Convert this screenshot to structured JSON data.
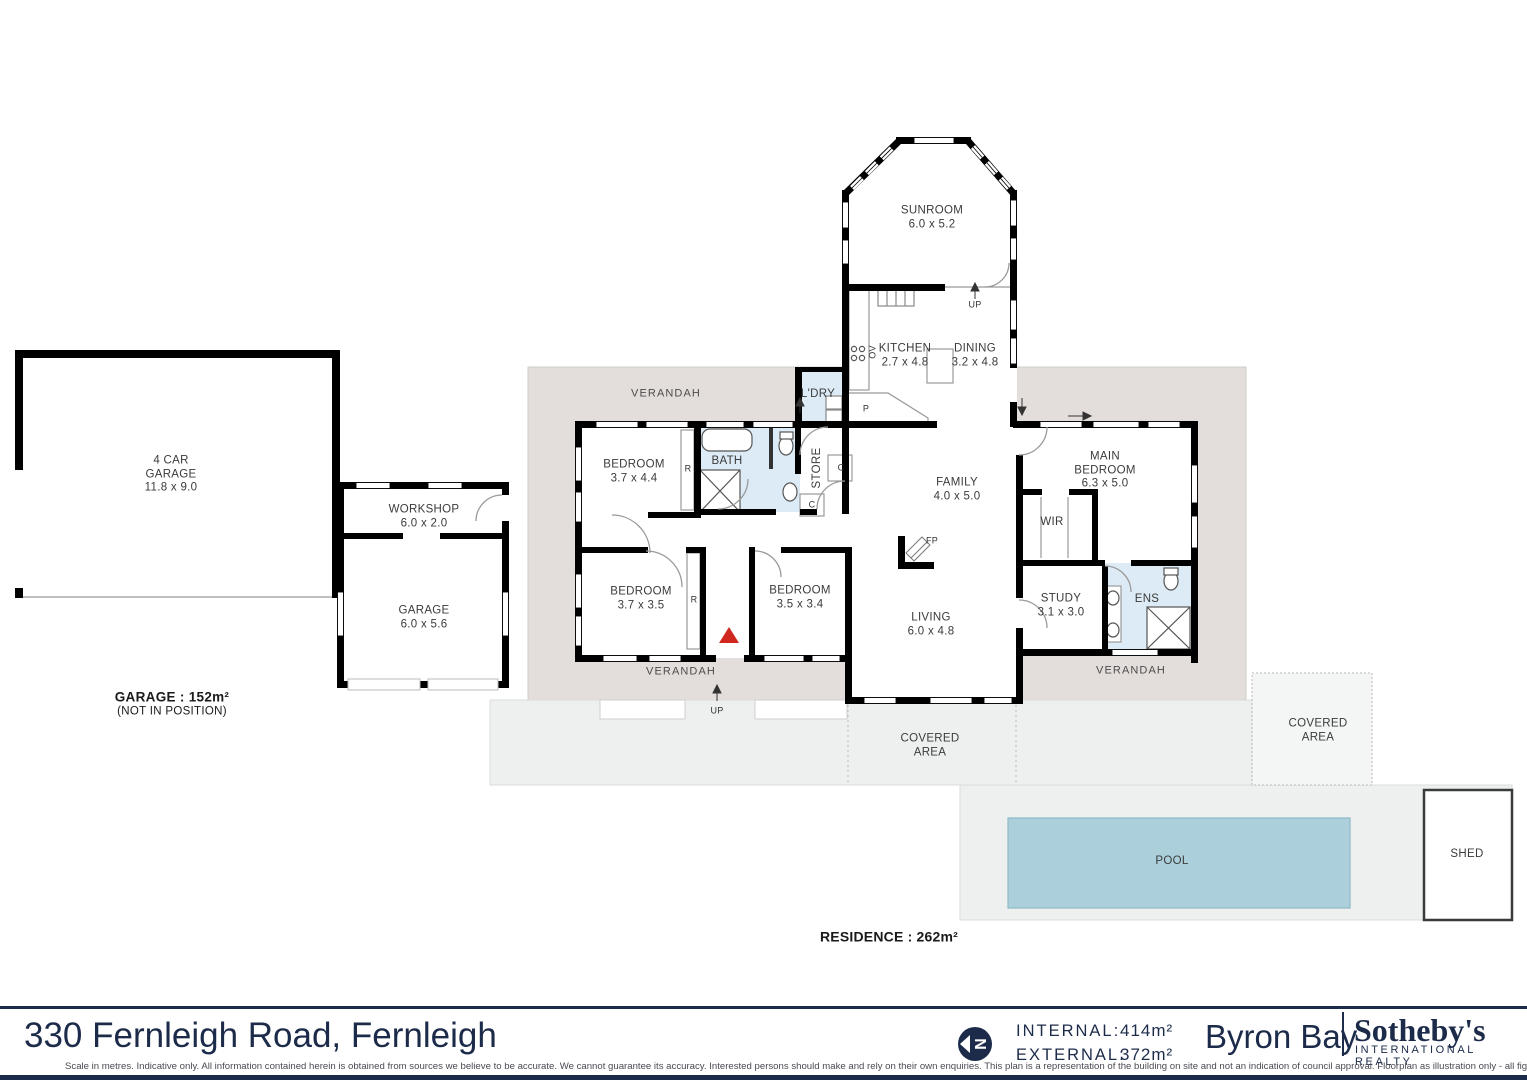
{
  "rooms": {
    "sunroom": {
      "name": "SUNROOM",
      "dims": "6.0 x 5.2"
    },
    "kitchen": {
      "name": "KITCHEN",
      "dims": "2.7 x 4.8"
    },
    "dining": {
      "name": "DINING",
      "dims": "3.2 x 4.8"
    },
    "laundry": {
      "name": "L'DRY"
    },
    "bath": {
      "name": "BATH"
    },
    "store": {
      "name": "STORE"
    },
    "bedroom1": {
      "name": "BEDROOM",
      "dims": "3.7 x 4.4"
    },
    "bedroom2": {
      "name": "BEDROOM",
      "dims": "3.7 x 3.5"
    },
    "bedroom3": {
      "name": "BEDROOM",
      "dims": "3.5 x 3.4"
    },
    "family": {
      "name": "FAMILY",
      "dims": "4.0 x 5.0"
    },
    "main_bedroom": {
      "name1": "MAIN",
      "name2": "BEDROOM",
      "dims": "6.3 x 5.0"
    },
    "wir": {
      "name": "WIR"
    },
    "study": {
      "name": "STUDY",
      "dims": "3.1 x 3.0"
    },
    "ens": {
      "name": "ENS"
    },
    "living": {
      "name": "LIVING",
      "dims": "6.0 x 4.8"
    },
    "garage_4car": {
      "name1": "4 CAR",
      "name2": "GARAGE",
      "dims": "11.8 x 9.0"
    },
    "workshop": {
      "name": "WORKSHOP",
      "dims": "6.0 x 2.0"
    },
    "garage_small": {
      "name": "GARAGE",
      "dims": "6.0 x 5.6"
    },
    "pool": {
      "name": "POOL"
    },
    "shed": {
      "name": "SHED"
    }
  },
  "outdoor": {
    "verandah_top": "VERANDAH",
    "verandah_bottom_left": "VERANDAH",
    "verandah_bottom_right": "VERANDAH",
    "covered_center_line1": "COVERED",
    "covered_center_line2": "AREA",
    "covered_right_line1": "COVERED",
    "covered_right_line2": "AREA"
  },
  "annotations": {
    "up_stairs": "UP",
    "up_verandah": "UP",
    "robe1": "R",
    "robe2": "R",
    "cupboard1": "C",
    "cupboard2": "C",
    "pantry": "P",
    "oven": "OV",
    "fireplace": "FP"
  },
  "notes": {
    "garage_area": "GARAGE : 152m²",
    "garage_position": "(NOT IN POSITION)",
    "residence_area": "RESIDENCE : 262m²"
  },
  "footer": {
    "address": "330 Fernleigh Road, Fernleigh",
    "internal_label": "INTERNAL:",
    "internal_value": "414m²",
    "external_label": "EXTERNAL:",
    "external_value": "372m²",
    "office": "Byron Bay",
    "brand": "Sotheby's",
    "brand_sub": "INTERNATIONAL REALTY",
    "compass_letter": "N",
    "disclaimer": "Scale in metres.  Indicative only. All information contained herein is obtained from sources we believe to be accurate. We cannot guarantee its accuracy. Interested persons should make and rely on their own enquiries. This plan is a representation of the building on site and not an indication of council approval. Floorplan as illustration only - all figured dimensisons appxamate - do not scale - no liability accepted."
  },
  "colors": {
    "navy": "#1c2b4a",
    "pool_fill": "#abd0dc",
    "wet_fill": "#dcebf5",
    "verandah_fill": "#e3dedb",
    "outdoor_fill": "#eef0f0",
    "entry_arrow": "#d0271e"
  }
}
